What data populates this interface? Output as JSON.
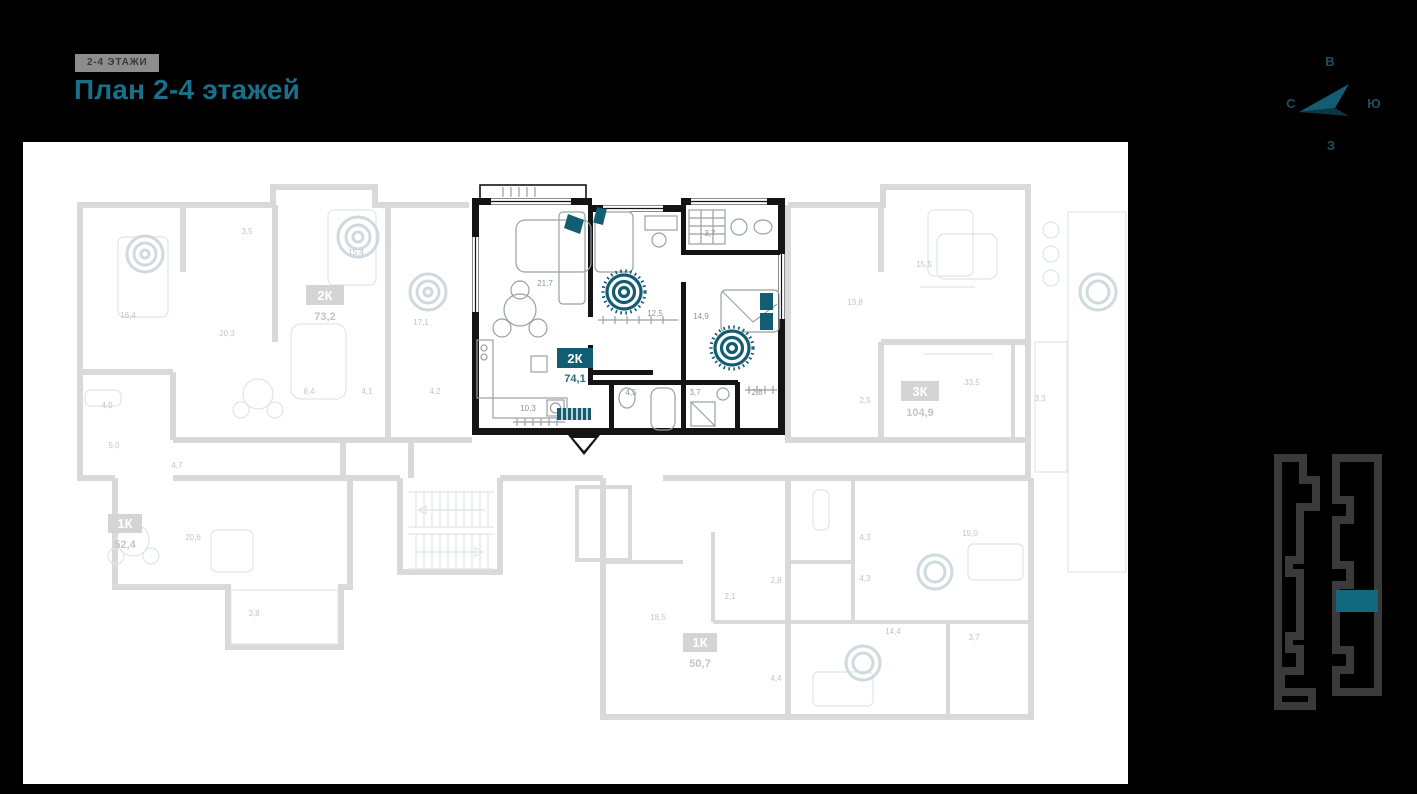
{
  "header": {
    "badge": "2-4 ЭТАЖИ",
    "title": "План 2-4 этажей"
  },
  "colors": {
    "accent_teal": "#135d72",
    "title_teal": "#1a7089",
    "plan_wall_gray": "#d9d9d9",
    "area_label_gray": "#c4c4c4",
    "highlight_wall": "#141414",
    "minimap_outline": "#3a3a3a"
  },
  "compass": {
    "top": "В",
    "right": "Ю",
    "bottom": "З",
    "left": "С"
  },
  "highlighted_unit": {
    "badge": "2К",
    "area": "74,1",
    "rooms": [
      {
        "name": "living-room",
        "area": "21,7"
      },
      {
        "name": "bedroom-1",
        "area": "12,5"
      },
      {
        "name": "bedroom-2",
        "area": "14,9"
      },
      {
        "name": "bathroom-top",
        "area": "3,7"
      },
      {
        "name": "bathroom-1",
        "area": "4,5"
      },
      {
        "name": "bathroom-2",
        "area": "3,7"
      },
      {
        "name": "wardrobe",
        "area": "2,8"
      },
      {
        "name": "hallway",
        "area": "10,3"
      }
    ]
  },
  "units": [
    {
      "badge": "2К",
      "area": "73,2"
    },
    {
      "badge": "3К",
      "area": "104,9"
    },
    {
      "badge": "1К",
      "area": "52,4"
    },
    {
      "badge": "1К",
      "area": "50,7"
    }
  ],
  "room_areas": [
    "16,4",
    "3,5",
    "20,3",
    "15,4",
    "17,1",
    "4,0",
    "6,4",
    "4,1",
    "4,2",
    "5,0",
    "4,7",
    "20,6",
    "3,8",
    "18,5",
    "2,1",
    "2,8",
    "4,4",
    "4,3",
    "4,3",
    "15,0",
    "14,4",
    "3,7",
    "15,5",
    "13,8",
    "33,5",
    "3,3",
    "2,5"
  ]
}
